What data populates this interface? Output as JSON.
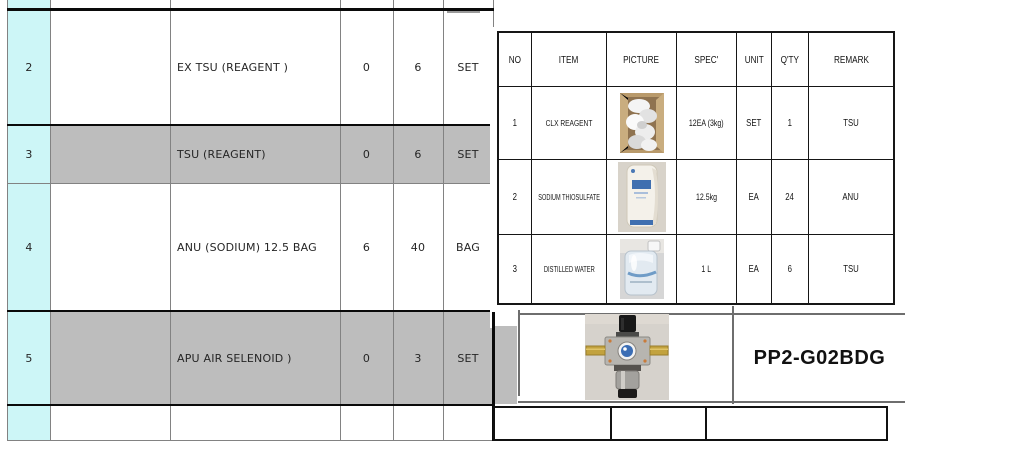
{
  "palette": {
    "row_number_fill": "#cdf6f7",
    "shaded_row_fill": "#bdbdbd",
    "grid_line": "#828282",
    "heavy_line": "#0a0a0a"
  },
  "main_table": {
    "rows": [
      {
        "no": "2",
        "desc": "EX TSU (REAGENT )",
        "qty1": "0",
        "qty2": "6",
        "unit": "SET"
      },
      {
        "no": "3",
        "desc": "TSU (REAGENT)",
        "qty1": "0",
        "qty2": "6",
        "unit": "SET"
      },
      {
        "no": "4",
        "desc": "ANU (SODIUM) 12.5 BAG",
        "qty1": "6",
        "qty2": "40",
        "unit": "BAG"
      },
      {
        "no": "5",
        "desc": "APU AIR SELENOID )",
        "qty1": "0",
        "qty2": "3",
        "unit": "SET"
      }
    ]
  },
  "spec_table": {
    "headers": [
      "NO",
      "ITEM",
      "PICTURE",
      "SPEC'",
      "UNIT",
      "Q'TY",
      "REMARK"
    ],
    "rows": [
      {
        "no": "1",
        "item": "CLX REAGENT",
        "picture": "box-of-reagent-bags",
        "spec": "12EA (3kg)",
        "unit": "SET",
        "qty": "1",
        "remark": "TSU"
      },
      {
        "no": "2",
        "item": "SODIUM THIOSULFATE",
        "picture": "white-chemical-bag",
        "spec": "12.5kg",
        "unit": "EA",
        "qty": "24",
        "remark": "ANU"
      },
      {
        "no": "3",
        "item": "DISTILLED WATER",
        "picture": "plastic-water-bottle",
        "spec": "1 L",
        "unit": "EA",
        "qty": "6",
        "remark": "TSU"
      }
    ]
  },
  "part_box": {
    "part_number": "PP2-G02BDG",
    "picture": "air-filter-regulator"
  }
}
